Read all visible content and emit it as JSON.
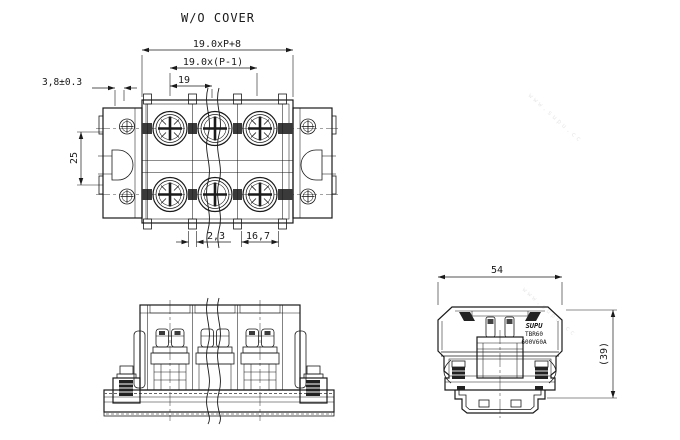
{
  "title": "W/O COVER",
  "top_view": {
    "dims": {
      "total_length": "19.0xP+8",
      "pole_centers": "19.0x(P-1)",
      "pitch": "19",
      "end_offset": "3,8±0.3",
      "depth": "25",
      "wall": "2,3",
      "opening": "16,7"
    }
  },
  "end_view": {
    "dims": {
      "width": "54",
      "height": "(39)"
    },
    "label": {
      "brand": "SUPU",
      "model": "TBR60",
      "rating": "600V60A"
    }
  },
  "watermark": "www.supu.cc",
  "colors": {
    "line": "#1a1a1a",
    "background": "#ffffff",
    "dark": "#222222"
  }
}
